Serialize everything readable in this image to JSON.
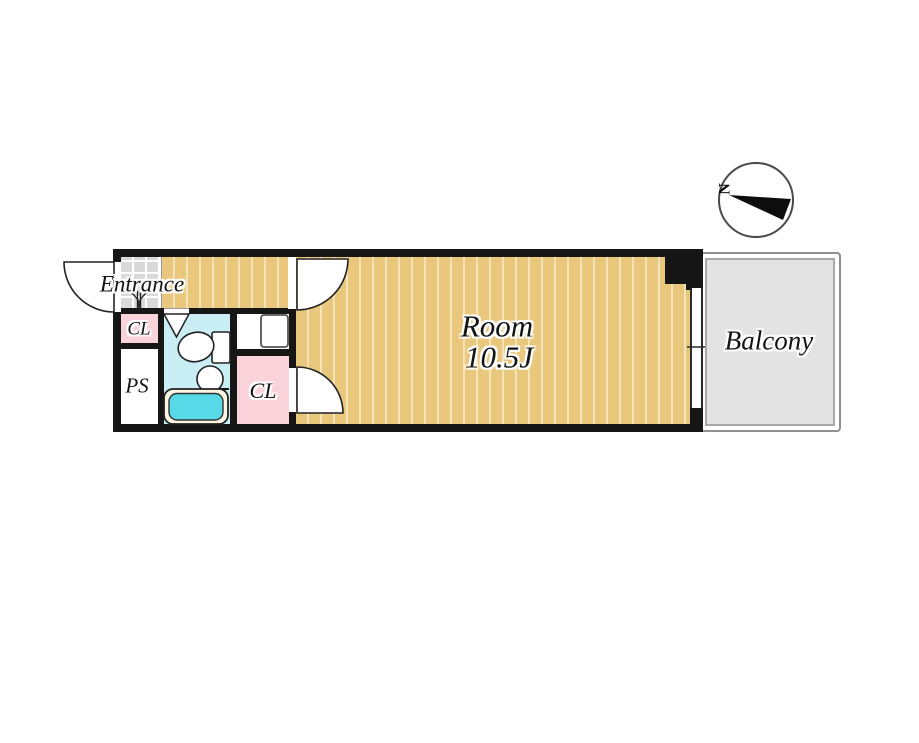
{
  "compass": {
    "north_label": "N"
  },
  "rooms": {
    "entrance": {
      "label": "Entrance"
    },
    "entrance_closet": {
      "label": "CL"
    },
    "pipe_space": {
      "label": "PS"
    },
    "room_closet": {
      "label": "CL"
    },
    "main_room": {
      "label": "Room",
      "size": "10.5J"
    },
    "balcony": {
      "label": "Balcony"
    }
  },
  "colors": {
    "wall": "#161616",
    "room_floor": "#e9c87e",
    "room_floor_stripe": "#f3e4b8",
    "entrance_tile": "#d9d9d9",
    "closet_fill": "#f9d2da",
    "bathroom_fill": "#c9eef4",
    "bathtub_water": "#57d9e7",
    "balcony_fill": "#e3e3e3"
  }
}
